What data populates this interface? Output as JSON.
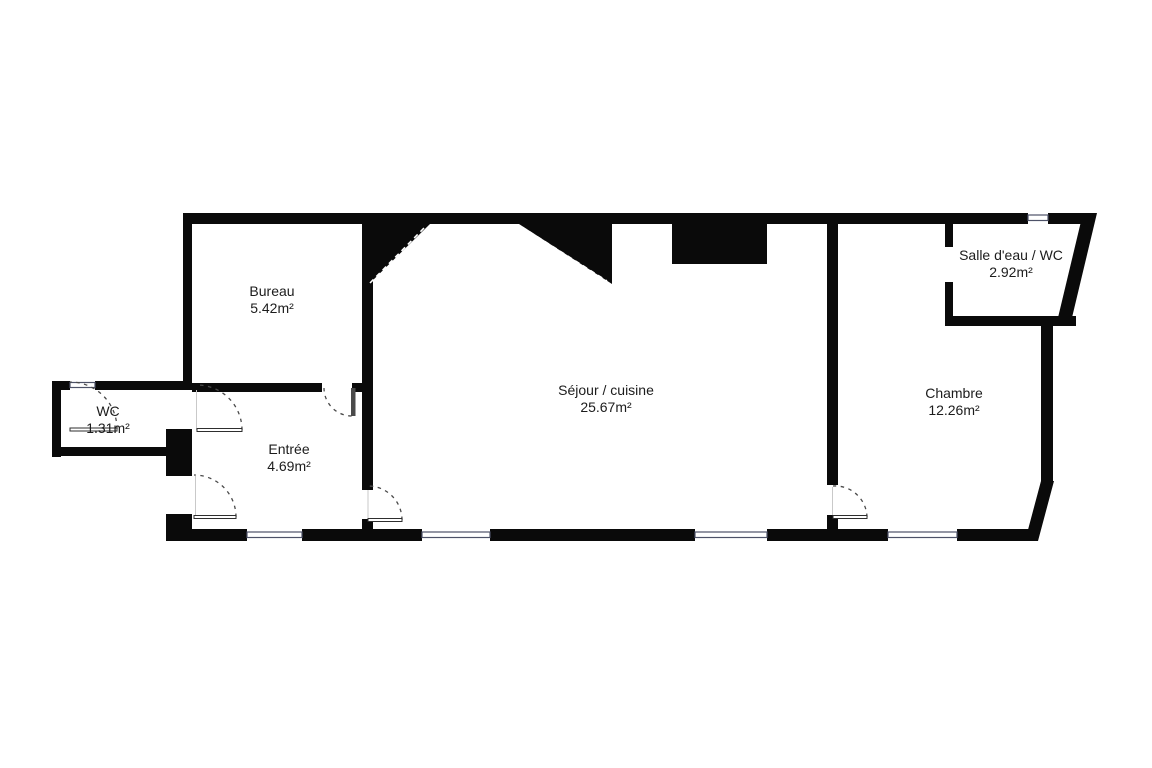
{
  "rooms": [
    {
      "id": "bureau",
      "name": "Bureau",
      "area": "5.42m²"
    },
    {
      "id": "wc",
      "name": "WC",
      "area": "1.31m²"
    },
    {
      "id": "entree",
      "name": "Entrée",
      "area": "4.69m²"
    },
    {
      "id": "sejour",
      "name": "Séjour / cuisine",
      "area": "25.67m²"
    },
    {
      "id": "chambre",
      "name": "Chambre",
      "area": "12.26m²"
    },
    {
      "id": "salle_eau",
      "name": "Salle d'eau / WC",
      "area": "2.92m²"
    }
  ],
  "colors": {
    "wall": "#0a0a0a",
    "background": "#ffffff",
    "window_line": "#4d5268",
    "door_arc": "#4a4a4a",
    "text": "#1c1c1c"
  }
}
